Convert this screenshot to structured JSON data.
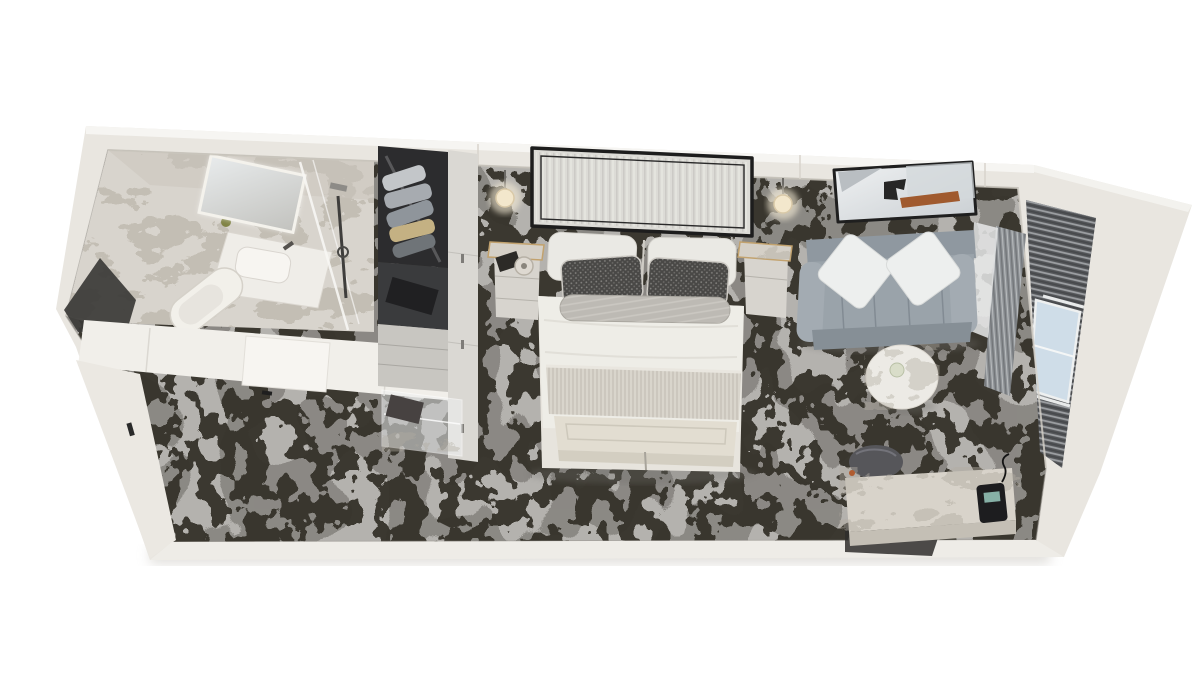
{
  "scene": {
    "description": "Top-down 3D cutaway rendering of a stateroom floor plan",
    "view": "dollhouse top-down perspective",
    "areas": {
      "bathroom": {
        "items": [
          "marble-walls",
          "vanity-sink",
          "lighted-mirror",
          "toilet",
          "glass-shower"
        ]
      },
      "wardrobe": {
        "items": [
          "hanging-clothes",
          "safe-shelf",
          "drawers",
          "glass-shelves",
          "cabinet-doors"
        ]
      },
      "sleeping": {
        "items": [
          "double-bed",
          "channel-tufted-headboard",
          "two-pillows",
          "two-patterned-accent-pillows",
          "bolster-cushion",
          "textured-bed-runner",
          "foot-bench",
          "nightstand-left",
          "nightstand-right",
          "wall-sconce-left",
          "wall-sconce-right"
        ]
      },
      "lounge": {
        "items": [
          "loveseat-sofa",
          "two-white-cushions",
          "abstract-wall-art",
          "round-marble-side-table"
        ]
      },
      "work": {
        "items": [
          "marble-top-desk",
          "telephone",
          "round-stool"
        ]
      },
      "exterior": {
        "items": [
          "window-wall",
          "balcony-door",
          "striped-drapes",
          "sheer-curtain"
        ]
      }
    },
    "floor": "abstract charcoal-on-grey patterned carpet"
  },
  "palette": {
    "background": "#ffffff",
    "wall": "#e9e6e0",
    "wall_top": "#f6f5f2",
    "carpet_base": "#b4b2ae",
    "carpet_pattern": "#34322c",
    "carpet_mottle": "#403e39",
    "marble_base": "#d8d4cd",
    "marble_vein": "#b2aca1",
    "bedding": "#eeede7",
    "bed_skirt": "#e7e4dd",
    "headboard": "#dcdbd6",
    "trim_dark": "#1d1d1d",
    "accent_pillow": "#494846",
    "bolster": "#bdbab4",
    "runner": "#d9d5cc",
    "bench": "#e2ddd1",
    "sofa": "#9aa3aa",
    "sofa_dark": "#868f96",
    "sofa_cushion": "#edefee",
    "art_accent": "#a05a2e",
    "art_dark": "#262626",
    "wood_gold": "#c2a26e",
    "wardrobe_interior": "#2c2c2e",
    "cabinet": "#dad8d3",
    "glass_blue": "#cfdde8",
    "drape": "#8e9296",
    "stool": "#56565a",
    "phone": "#1d1d1f",
    "sconce_glow": "#f3e7cc"
  }
}
